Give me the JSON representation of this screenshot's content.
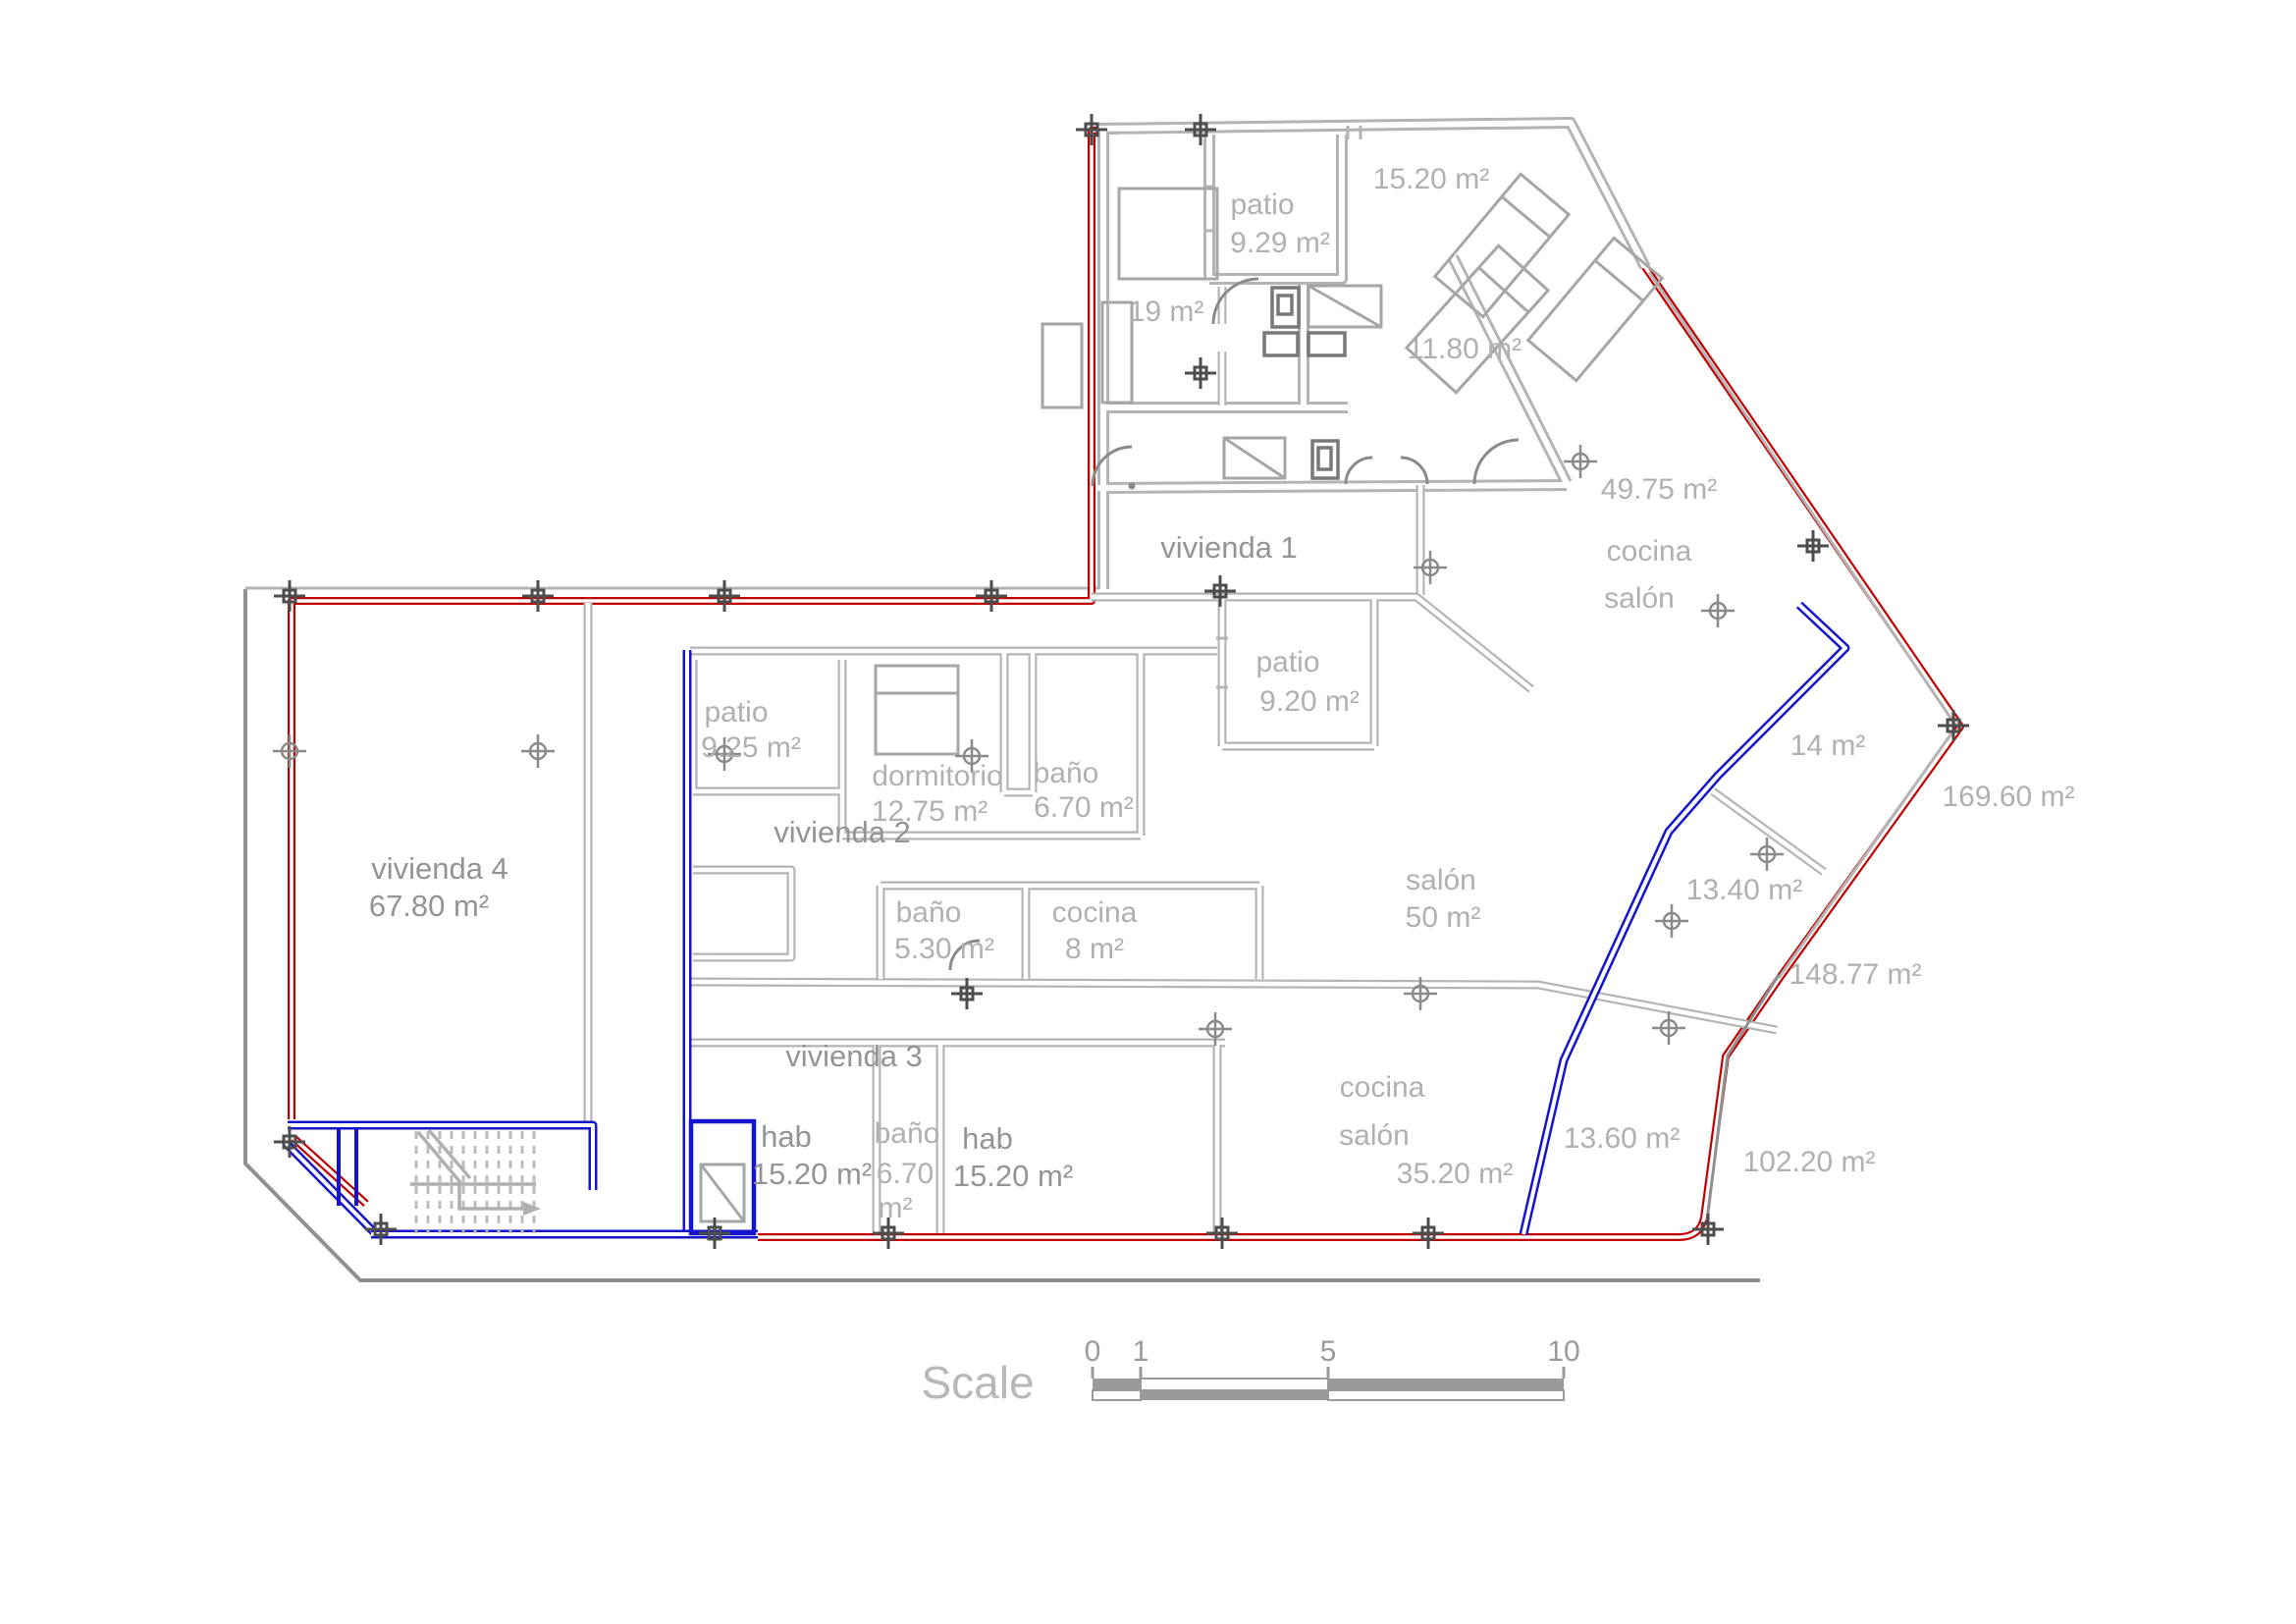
{
  "colors": {
    "perimeter_red": "#c00000",
    "boundary_blue": "#1414cc",
    "walls_gray": "#b4b4b4",
    "marker_dark": "#4d4d4d",
    "label_gray": "#b0b0b0"
  },
  "rooms": {
    "v1_name": "vivienda 1",
    "v1_patio_a_name": "patio",
    "v1_patio_a_area": "9.29 m²",
    "v1_room_1520_area": "15.20 m²",
    "v1_room_19_area": "19 m²",
    "v1_room_1180_area": "11.80 m²",
    "v1_area_4975": "49.75 m²",
    "v1_cocina": "cocina",
    "v1_salon": "salón",
    "v1_patio_b_name": "patio",
    "v1_patio_b_area": "9.20 m²",
    "v1_salon50_name": "salón",
    "v1_salon50_area": "50 m²",
    "room_14_area": "14 m²",
    "v2_name": "vivienda 2",
    "v2_patio_name": "patio",
    "v2_patio_area": "9.25 m²",
    "v2_dorm_name": "dormitorio",
    "v2_dorm_area": "12.75 m²",
    "v2_bano_name": "baño",
    "v2_bano_area": "6.70 m²",
    "v2_bano2_name": "baño",
    "v2_bano2_area": "5.30 m²",
    "v2_cocina_name": "cocina",
    "v2_cocina_area": "8 m²",
    "v3_name": "vivienda 3",
    "v3_hab1_name": "hab",
    "v3_hab1_area": "15.20 m²",
    "v3_bano_name": "baño",
    "v3_bano_area_value": "6.70",
    "v3_bano_area_unit": "m²",
    "v3_hab2_name": "hab",
    "v3_hab2_area": "15.20 m²",
    "v3_cocina": "cocina",
    "v3_salon": "salón",
    "v3_area": "35.20 m²",
    "v4_name": "vivienda 4",
    "v4_area": "67.80 m²"
  },
  "parcels": {
    "p_16960": "169.60 m²",
    "p_14877": "148.77 m²",
    "p_10220": "102.20 m²",
    "p_1340": "13.40 m²",
    "p_1360": "13.60 m²"
  },
  "scale_bar": {
    "title": "Scale",
    "ticks": [
      "0",
      "1",
      "5",
      "10"
    ]
  }
}
